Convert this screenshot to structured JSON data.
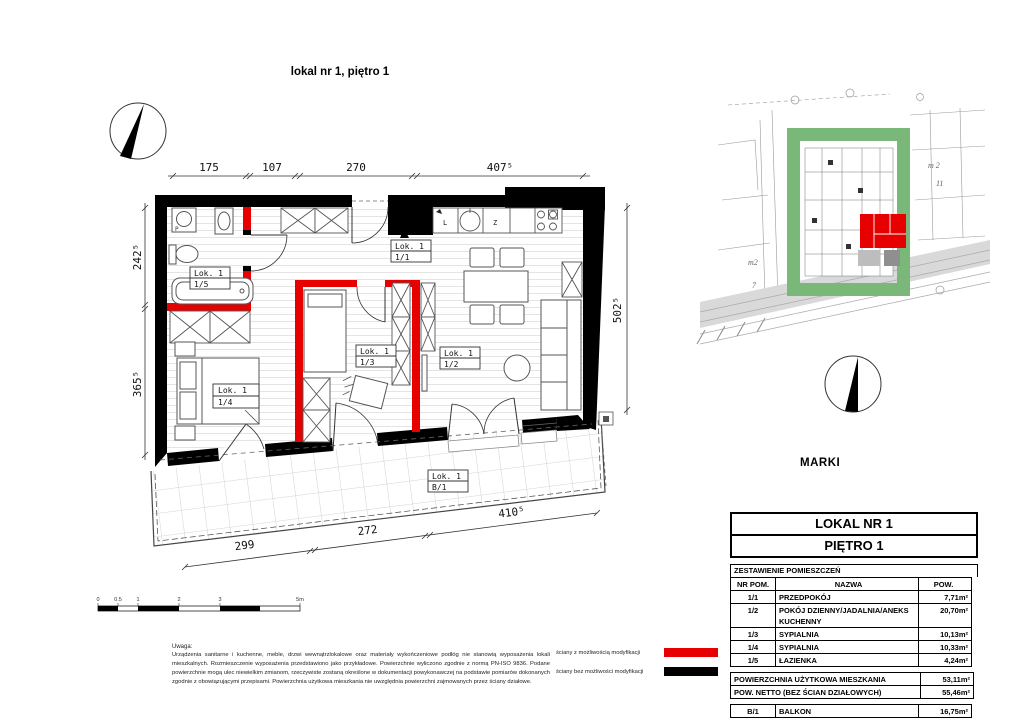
{
  "title": "lokal nr 1, piętro 1",
  "floor_plan": {
    "dims": {
      "top": [
        "175",
        "107",
        "270",
        "407⁵"
      ],
      "left": [
        "242⁵",
        "365⁵"
      ],
      "right": "502⁵",
      "bottom": [
        "299",
        "272",
        "410⁵"
      ]
    },
    "rooms": {
      "r15": {
        "line1": "Lok. 1",
        "line2": "1/5"
      },
      "r11": {
        "line1": "Lok. 1",
        "line2": "1/1"
      },
      "r13": {
        "line1": "Lok. 1",
        "line2": "1/3"
      },
      "r12": {
        "line1": "Lok. 1",
        "line2": "1/2"
      },
      "r14": {
        "line1": "Lok. 1",
        "line2": "1/4"
      },
      "b1": {
        "line1": "Lok. 1",
        "line2": "B/1"
      }
    },
    "kitchen": {
      "fridge_label": "L",
      "sink_label": "Z"
    },
    "bathroom": {
      "washer_label": "P"
    },
    "colors": {
      "wall_modifiable": "#e60000",
      "wall_fixed": "#000000"
    }
  },
  "site_plan": {
    "city": "MARKI",
    "parcel_labels": [
      "m2",
      "7",
      "m 2",
      "11"
    ],
    "highlight_color": "#e60000",
    "plot_color": "#7ab87a"
  },
  "scale_bar": {
    "ticks": [
      "0",
      "0.5",
      "1",
      "2",
      "3",
      "5m"
    ]
  },
  "legend": {
    "items": [
      {
        "label": "ściany z możliwością modyfikacji",
        "color": "#e60000"
      },
      {
        "label": "ściany bez możliwości modyfikacji",
        "color": "#000000"
      }
    ]
  },
  "notes": {
    "heading": "Uwaga:",
    "body": "Urządzenia sanitarne i kuchenne, meble, drzwi wewnątrzlokalowe oraz materiały wykończeniowe podłóg nie stanowią wyposażenia lokali mieszkalnych. Rozmieszczenie wyposażenia przedstawiono jako przykładowe. Powierzchnie wyliczono zgodnie z normą PN-ISO 9836. Podane powierzchnie mogą ulec niewielkim zmianom, rzeczywiste zostaną określone w dokumentacji powykonawczej na podstawie pomiarów dokonanych zgodnie z obowiązującymi przepisami. Powierzchnia użytkowa mieszkania nie uwzględnia powierzchni zajmowanych przez ściany działowe."
  },
  "summary": {
    "title_line1": "LOKAL NR 1",
    "title_line2": "PIĘTRO 1",
    "section_title": "ZESTAWIENIE POMIESZCZEŃ",
    "headers": {
      "nr": "NR POM.",
      "name": "NAZWA",
      "area": "POW."
    },
    "rows": [
      {
        "nr": "1/1",
        "name": "PRZEDPOKÓJ",
        "area": "7,71m²"
      },
      {
        "nr": "1/2",
        "name": "POKÓJ DZIENNY/JADALNIA/ANEKS KUCHENNY",
        "area": "20,70m²"
      },
      {
        "nr": "1/3",
        "name": "SYPIALNIA",
        "area": "10,13m²"
      },
      {
        "nr": "1/4",
        "name": "SYPIALNIA",
        "area": "10,33m²"
      },
      {
        "nr": "1/5",
        "name": "ŁAZIENKA",
        "area": "4,24m²"
      }
    ],
    "totals": [
      {
        "label": "POWIERZCHNIA UŻYTKOWA MIESZKANIA",
        "value": "53,11m²"
      },
      {
        "label": "POW. NETTO (BEZ ŚCIAN DZIAŁOWYCH)",
        "value": "55,46m²"
      }
    ],
    "balcony_row": {
      "nr": "B/1",
      "name": "BALKON",
      "area": "16,75m²"
    }
  }
}
